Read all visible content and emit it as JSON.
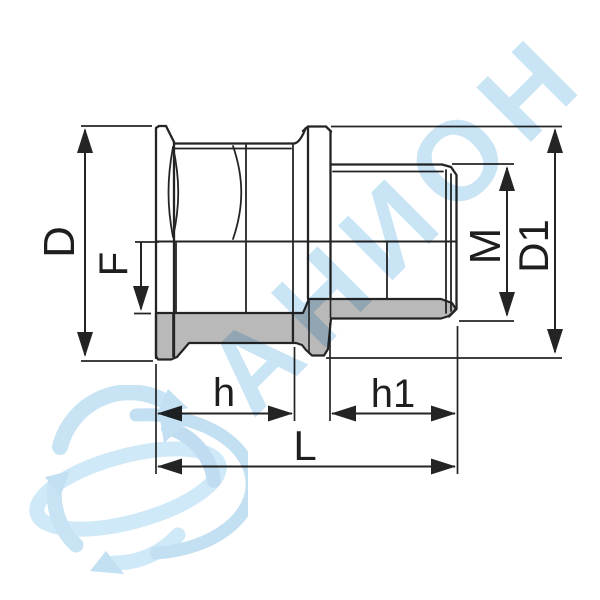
{
  "canvas": {
    "background": "#ffffff"
  },
  "watermark": {
    "brand_text": "АНИОН",
    "text_color": "#c9e4f5",
    "logo_color": "#c3e0f2",
    "logo_name": "globe-swirl-logo"
  },
  "drawing": {
    "type": "technical-line-drawing",
    "subject": "threaded-adapter-fitting-side-view",
    "line_color": "#242424",
    "shading_color": "#b9b9b9",
    "dimensions": [
      {
        "id": "D",
        "label": "D",
        "orientation": "vertical"
      },
      {
        "id": "F",
        "label": "F",
        "orientation": "vertical"
      },
      {
        "id": "M",
        "label": "M",
        "orientation": "vertical"
      },
      {
        "id": "D1",
        "label": "D1",
        "orientation": "vertical"
      },
      {
        "id": "h",
        "label": "h",
        "orientation": "horizontal"
      },
      {
        "id": "h1",
        "label": "h1",
        "orientation": "horizontal"
      },
      {
        "id": "L",
        "label": "L",
        "orientation": "horizontal"
      }
    ]
  }
}
